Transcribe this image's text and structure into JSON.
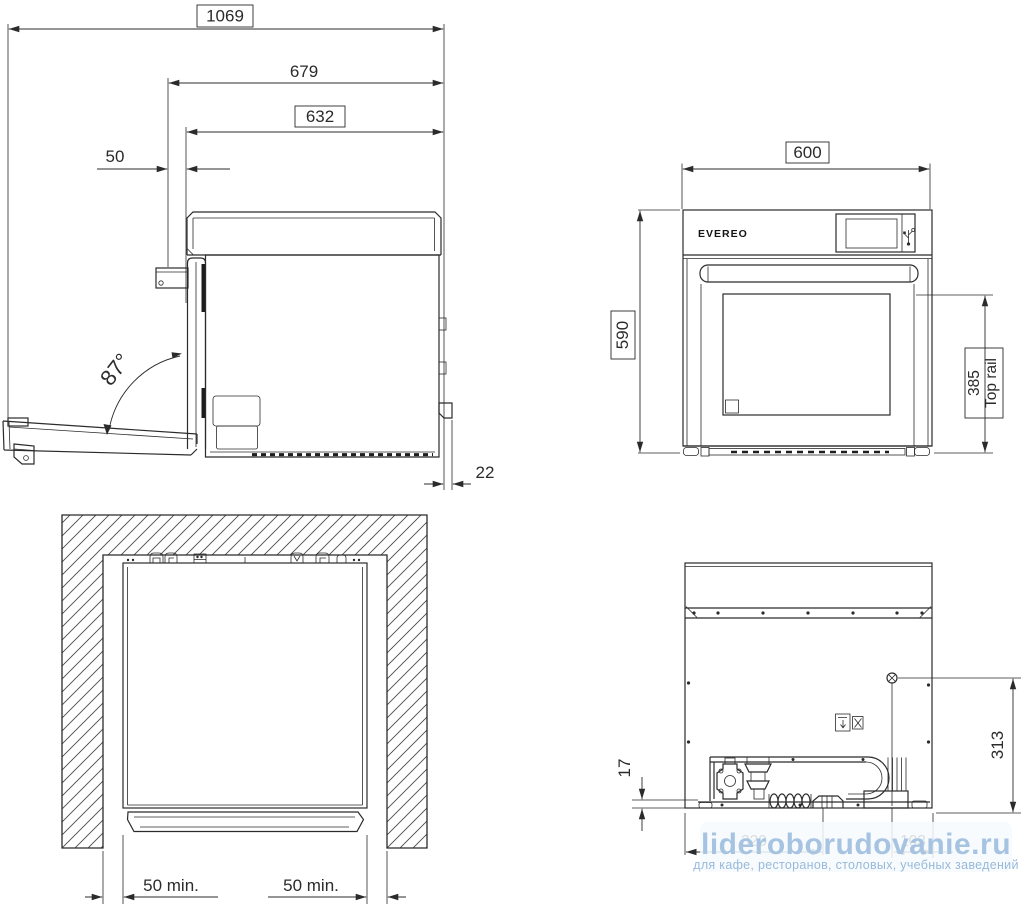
{
  "colors": {
    "line": "#2b2b2b",
    "background": "#ffffff",
    "watermark_text": "#a6c4e1",
    "watermark_tagline": "#97b9da"
  },
  "side": {
    "dim_overall": "1069",
    "dim_door_open_depth": "679",
    "dim_body_depth": "632",
    "dim_front_offset": "50",
    "door_open_angle": "87°",
    "dim_rear_clearance": "22"
  },
  "front": {
    "brand": "EVEREO",
    "dim_width": "600",
    "dim_height": "590",
    "dim_top_rail_value": "385",
    "dim_top_rail_label": "Top rail"
  },
  "plan": {
    "dim_left_clearance": "50 min.",
    "dim_right_clearance": "50 min."
  },
  "rear": {
    "dim_base_height": "17",
    "dim_connection_height": "313",
    "dim_bottom_left": "320",
    "dim_bottom_right": "103"
  },
  "watermark": {
    "site": "lideroborudovanie.ru",
    "tagline": "для кафе, ресторанов, столовых, учебных заведений"
  }
}
